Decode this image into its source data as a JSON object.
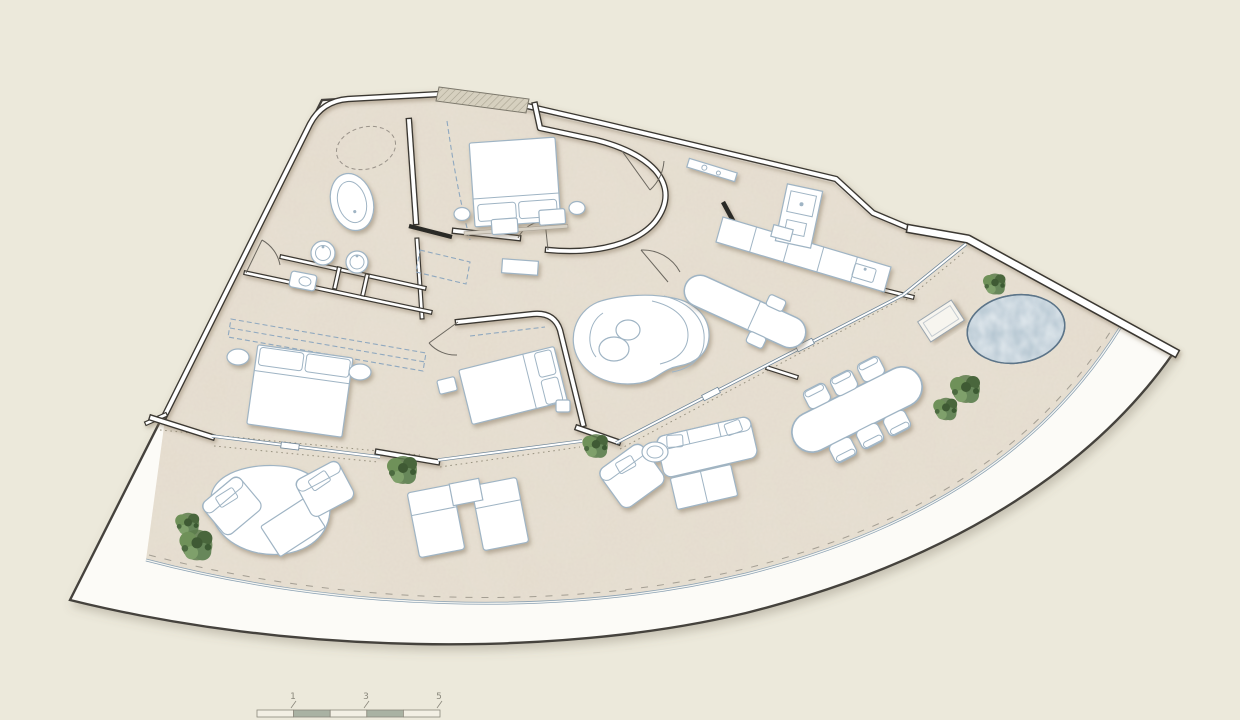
{
  "page": {
    "background": "#ece9db"
  },
  "drawing": {
    "kind": "architectural floor plan, fan-shaped apartment, top view",
    "rooms": [
      "entry-corridor",
      "master-bedroom",
      "bathroom",
      "bedroom-2",
      "bedroom-3",
      "hallway",
      "kitchen",
      "living-room",
      "pool-terrace",
      "main-terrace"
    ],
    "fixtures": [
      "oval-bathtub",
      "twin-basins",
      "toilet",
      "shower-outline",
      "kitchen-island",
      "kitchen-counter",
      "oven-column"
    ],
    "outdoor_features": [
      "circular-pool",
      "planter-tray",
      "glass-balustrade",
      "round-daybed",
      "armchairs",
      "sun-loungers",
      "outdoor-lounge-set",
      "outdoor-dining-table",
      "six-dining-chairs",
      "shrubs"
    ]
  },
  "scale_bar": {
    "labels": [
      "1",
      "3",
      "5"
    ]
  },
  "palette": {
    "canvas": "#ece9db",
    "slab": "#fcfbf7",
    "floor": "#e8e1d4",
    "wall": "#3b3833",
    "furniture_line": "#9fb4c4",
    "glass": "#6f8699",
    "water": "#b3c4d0",
    "water_deep": "#7e99ab",
    "plant": "#5d7c4c",
    "label": "#8a887c",
    "scale_dark": "#a9b2a3",
    "scale_light": "#f2efe4"
  }
}
